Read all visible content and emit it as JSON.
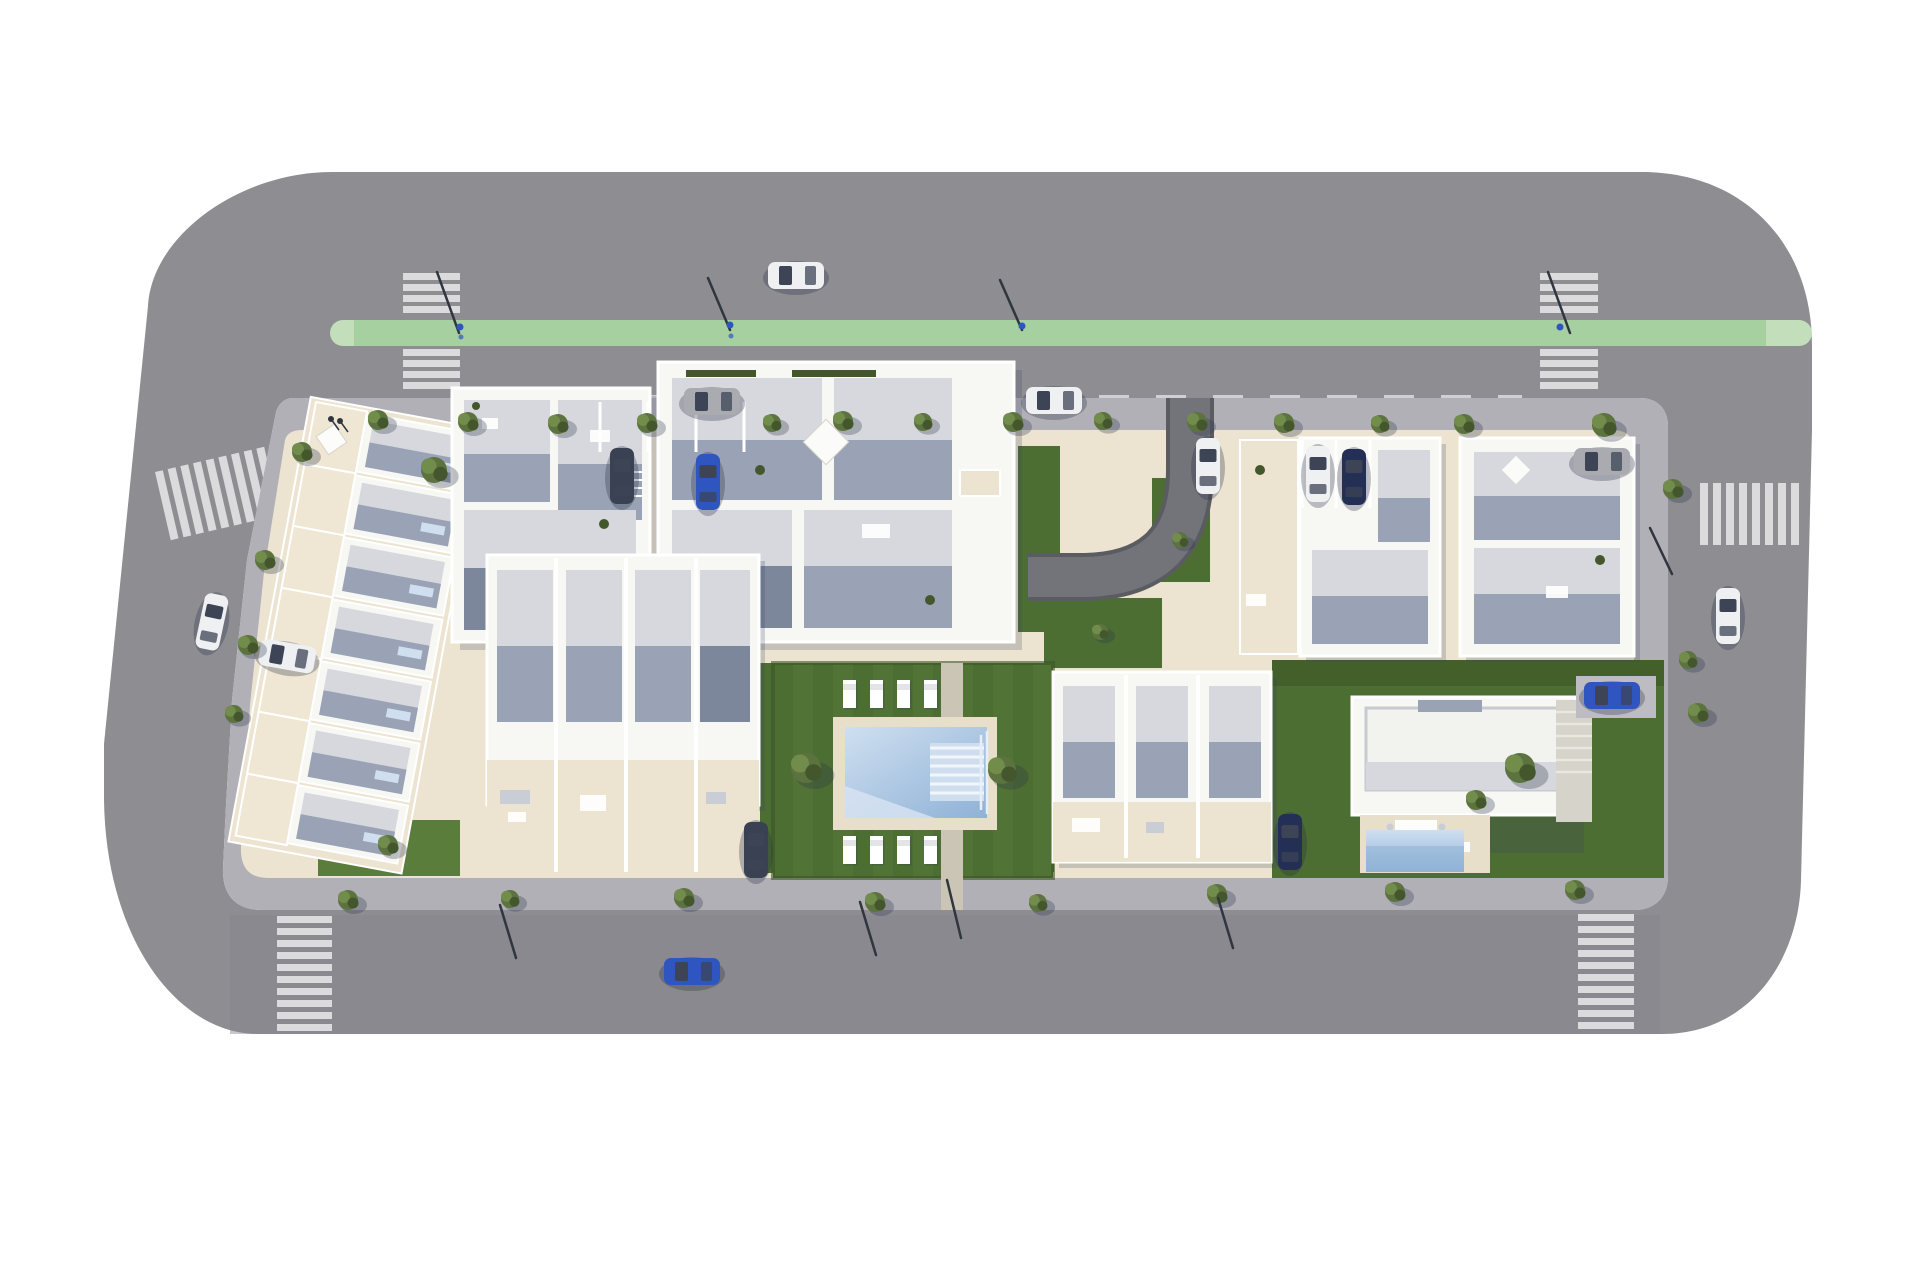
{
  "scene": {
    "type": "aerial-3d-site-plan-rendering",
    "description": "Top-down 3D architectural rendering of a residential development block bounded by gray asphalt roads, with a green bike lane along the top street, six zebra crossings, white apartment buildings and townhouses, a communal pool with sun loungers, a detached villa with private pool, lawns, street trees and parked/driving cars",
    "background": "#ffffff"
  },
  "palette": {
    "bg": "#ffffff",
    "road": "#8d8d92",
    "road-dark": "#86868b",
    "lane": "#a7d0a0",
    "lane-light": "#c2deba",
    "stripe": "#dbdbde",
    "dash": "#cfcfd4",
    "walk": "#b1b0b6",
    "walk-light": "#bdbcc2",
    "beige": "#ece4d0",
    "beige-dark": "#ddd3bc",
    "lawn": "#4d6e32",
    "lawn-light": "#5a7d3b",
    "lawn-dark": "#3c5526",
    "deck": "#e7dfca",
    "pool-hi": "#cfdff0",
    "pool": "#abc6e2",
    "pool-deep": "#8fb2d6",
    "wall": "#f7f7f4",
    "roof-light": "#d7d8dd",
    "roof": "#c9ccd4",
    "shadow": "#9aa3b5",
    "shadow-dark": "#7c879c",
    "drive": "#73747a",
    "drive-edge": "#5b5c62",
    "tree": "#5c7340",
    "tree-dark": "#44572c",
    "tree-light": "#728c4c",
    "car-white": "#eef0f2",
    "car-gray": "#a9abb0",
    "car-blue": "#2e55c0",
    "car-navy": "#232f55",
    "car-dark": "#3a4152",
    "glass": "#3c4456",
    "pole": "#30363f"
  },
  "inventory": {
    "roads": [
      "top-street-with-bike-lane",
      "left-street-diagonal",
      "bottom-street",
      "right-street"
    ],
    "bike_lane": {
      "color_name": "green",
      "position": "top-street",
      "cyclists": 2
    },
    "crosswalks": [
      {
        "id": "top-left-zebra",
        "orientation": "vertical"
      },
      {
        "id": "top-right-zebra",
        "orientation": "vertical"
      },
      {
        "id": "left-zebra",
        "orientation": "horizontal-slanted"
      },
      {
        "id": "bottom-left-ladder",
        "orientation": "vertical"
      },
      {
        "id": "bottom-right-ladder",
        "orientation": "vertical"
      },
      {
        "id": "right-zebra",
        "orientation": "horizontal"
      }
    ],
    "buildings": [
      {
        "id": "terraced-row",
        "kind": "townhouse-row",
        "units": 7,
        "note": "diagonal row along left edge with roof pools"
      },
      {
        "id": "building-a",
        "kind": "apartment-block",
        "position": "top-mid-left"
      },
      {
        "id": "building-b",
        "kind": "apartment-block-large",
        "position": "top-center"
      },
      {
        "id": "building-f",
        "kind": "apartment-block",
        "position": "top-right-center"
      },
      {
        "id": "building-g",
        "kind": "apartment-block",
        "position": "top-right"
      },
      {
        "id": "building-c",
        "kind": "townhouse-block",
        "units": 4,
        "position": "bottom-mid-left"
      },
      {
        "id": "building-d",
        "kind": "townhouse-block",
        "units": 3,
        "position": "bottom-right-center"
      },
      {
        "id": "villa-e",
        "kind": "detached-villa-with-pool",
        "position": "bottom-right"
      }
    ],
    "amenities": [
      "communal-pool",
      "pool-deck",
      "sun-loungers",
      "villa-private-pool",
      "curved-driveway",
      "lawns",
      "roof-terraces"
    ],
    "sun_loungers": 8,
    "vehicles": [
      {
        "color": "white",
        "state": "driving",
        "location": "top-street"
      },
      {
        "color": "gray",
        "state": "parked",
        "location": "top-street-curb-left"
      },
      {
        "color": "white",
        "state": "parked",
        "location": "top-street-curb-right"
      },
      {
        "color": "dark",
        "state": "parked",
        "location": "block-parking-bay"
      },
      {
        "color": "blue",
        "state": "parked",
        "location": "block-parking-bay"
      },
      {
        "color": "white",
        "state": "driving",
        "location": "curved-driveway"
      },
      {
        "color": "white",
        "state": "parked",
        "location": "building-f-bay"
      },
      {
        "color": "navy",
        "state": "parked",
        "location": "building-f-bay"
      },
      {
        "color": "gray",
        "state": "parked",
        "location": "building-g-terrace"
      },
      {
        "color": "white",
        "state": "driving",
        "location": "right-street"
      },
      {
        "color": "blue",
        "state": "parked",
        "location": "villa-pad"
      },
      {
        "color": "navy",
        "state": "parked",
        "location": "building-d-lane"
      },
      {
        "color": "dark",
        "state": "parked",
        "location": "building-c-lane"
      },
      {
        "color": "white",
        "state": "parked",
        "location": "left-street-diagonal"
      },
      {
        "color": "white",
        "state": "parked",
        "location": "block-southwest-corner"
      },
      {
        "color": "blue",
        "state": "driving",
        "location": "bottom-street"
      }
    ],
    "street_trees": 30,
    "pedestrians": 2
  }
}
